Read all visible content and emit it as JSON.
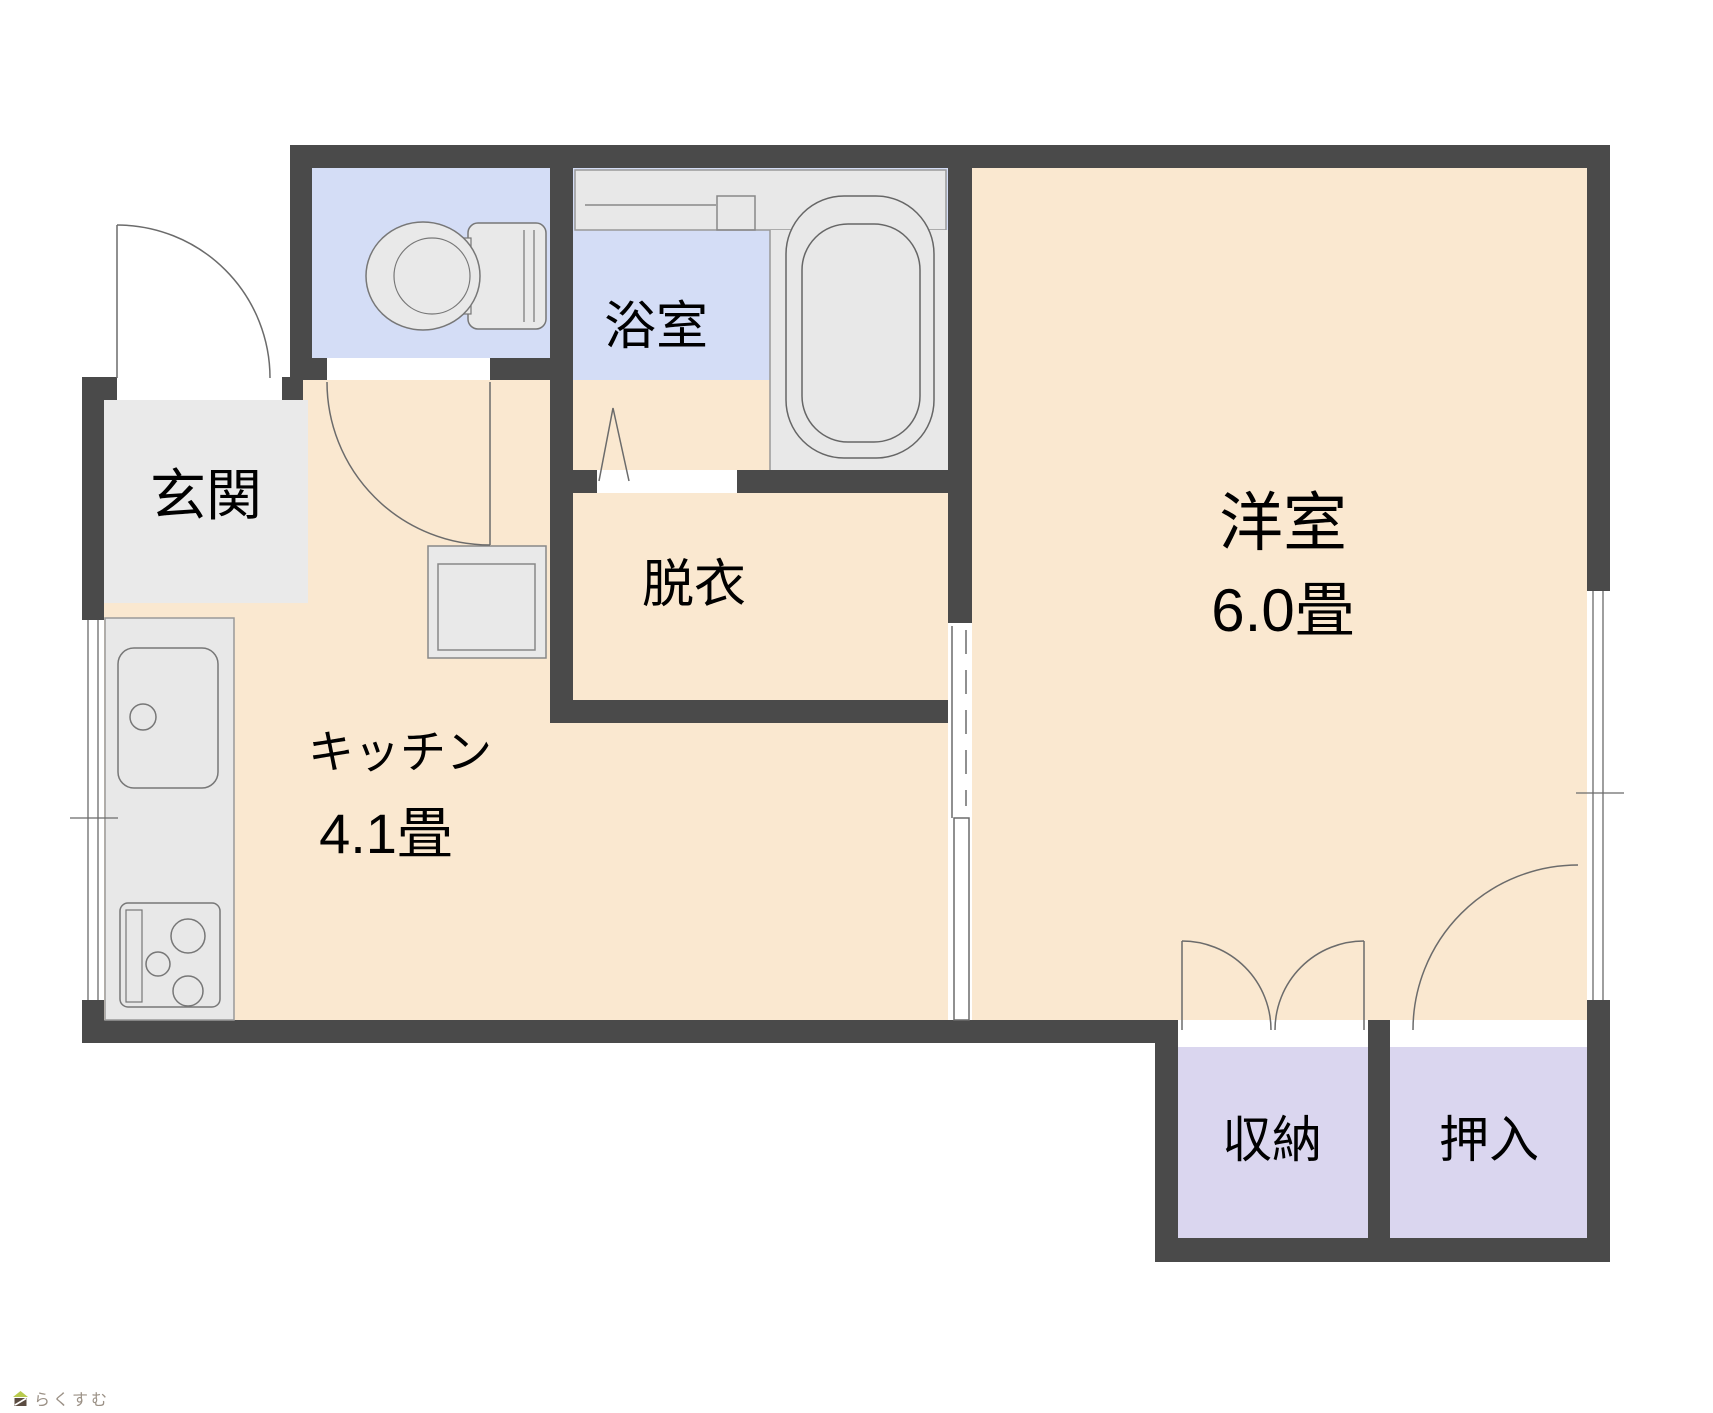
{
  "rooms": {
    "genkan": {
      "label": "玄関"
    },
    "toilet": {
      "label": ""
    },
    "bath": {
      "label": "浴室"
    },
    "datsui": {
      "label": "脱衣"
    },
    "kitchen": {
      "label": "キッチン",
      "size": "4.1畳"
    },
    "western": {
      "label": "洋室",
      "size": "6.0畳"
    },
    "shuno": {
      "label": "収納"
    },
    "oshiire": {
      "label": "押入"
    }
  },
  "fixtures": {
    "toilet": "toilet-icon",
    "bathtub": "bathtub-icon",
    "bath_counter": "bath-counter-icon",
    "kitchen_counter": "kitchen-counter-icon",
    "sink": "kitchen-sink-icon",
    "stove": "stove-icon",
    "washer": "washing-machine-pan-icon",
    "entry_door": "entry-door-arc",
    "toilet_door": "toilet-door-arc",
    "bath_folding_door": "folding-door-icon",
    "sliding_door": "sliding-door-icon",
    "shuno_double_door": "double-door-arcs",
    "oshiire_door": "door-arc",
    "windows": "window-icon"
  },
  "colors": {
    "wall": "#4a4a4a",
    "floor_beige": "#fae8d0",
    "room_blue": "#d4ddf6",
    "closet_lavender": "#dad6ef",
    "entry_gray": "#eaeaea",
    "fixture_gray": "#e8e8e8",
    "line": "#6b6b6b"
  },
  "logo": {
    "text": "らくすむ",
    "icon": "house-logo-icon"
  }
}
